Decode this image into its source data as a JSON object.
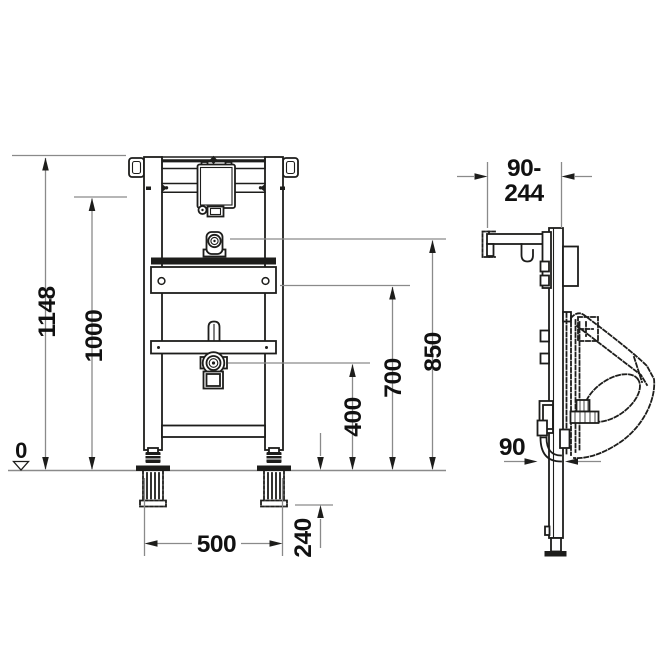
{
  "dims": {
    "overall_height": "1148",
    "upper_rail_height": "1000",
    "floor_datum": "0",
    "frame_width": "500",
    "floor_adjustment": "240",
    "drain_height": "400",
    "fixing_height": "700",
    "connection_height": "850",
    "depth_range_line1": "90-",
    "depth_range_line2": "244",
    "outlet_depth": "90"
  },
  "colors": {
    "drawing_line": "#1d1d1b",
    "dimension_line": "#8a8a8a",
    "background": "#ffffff"
  }
}
